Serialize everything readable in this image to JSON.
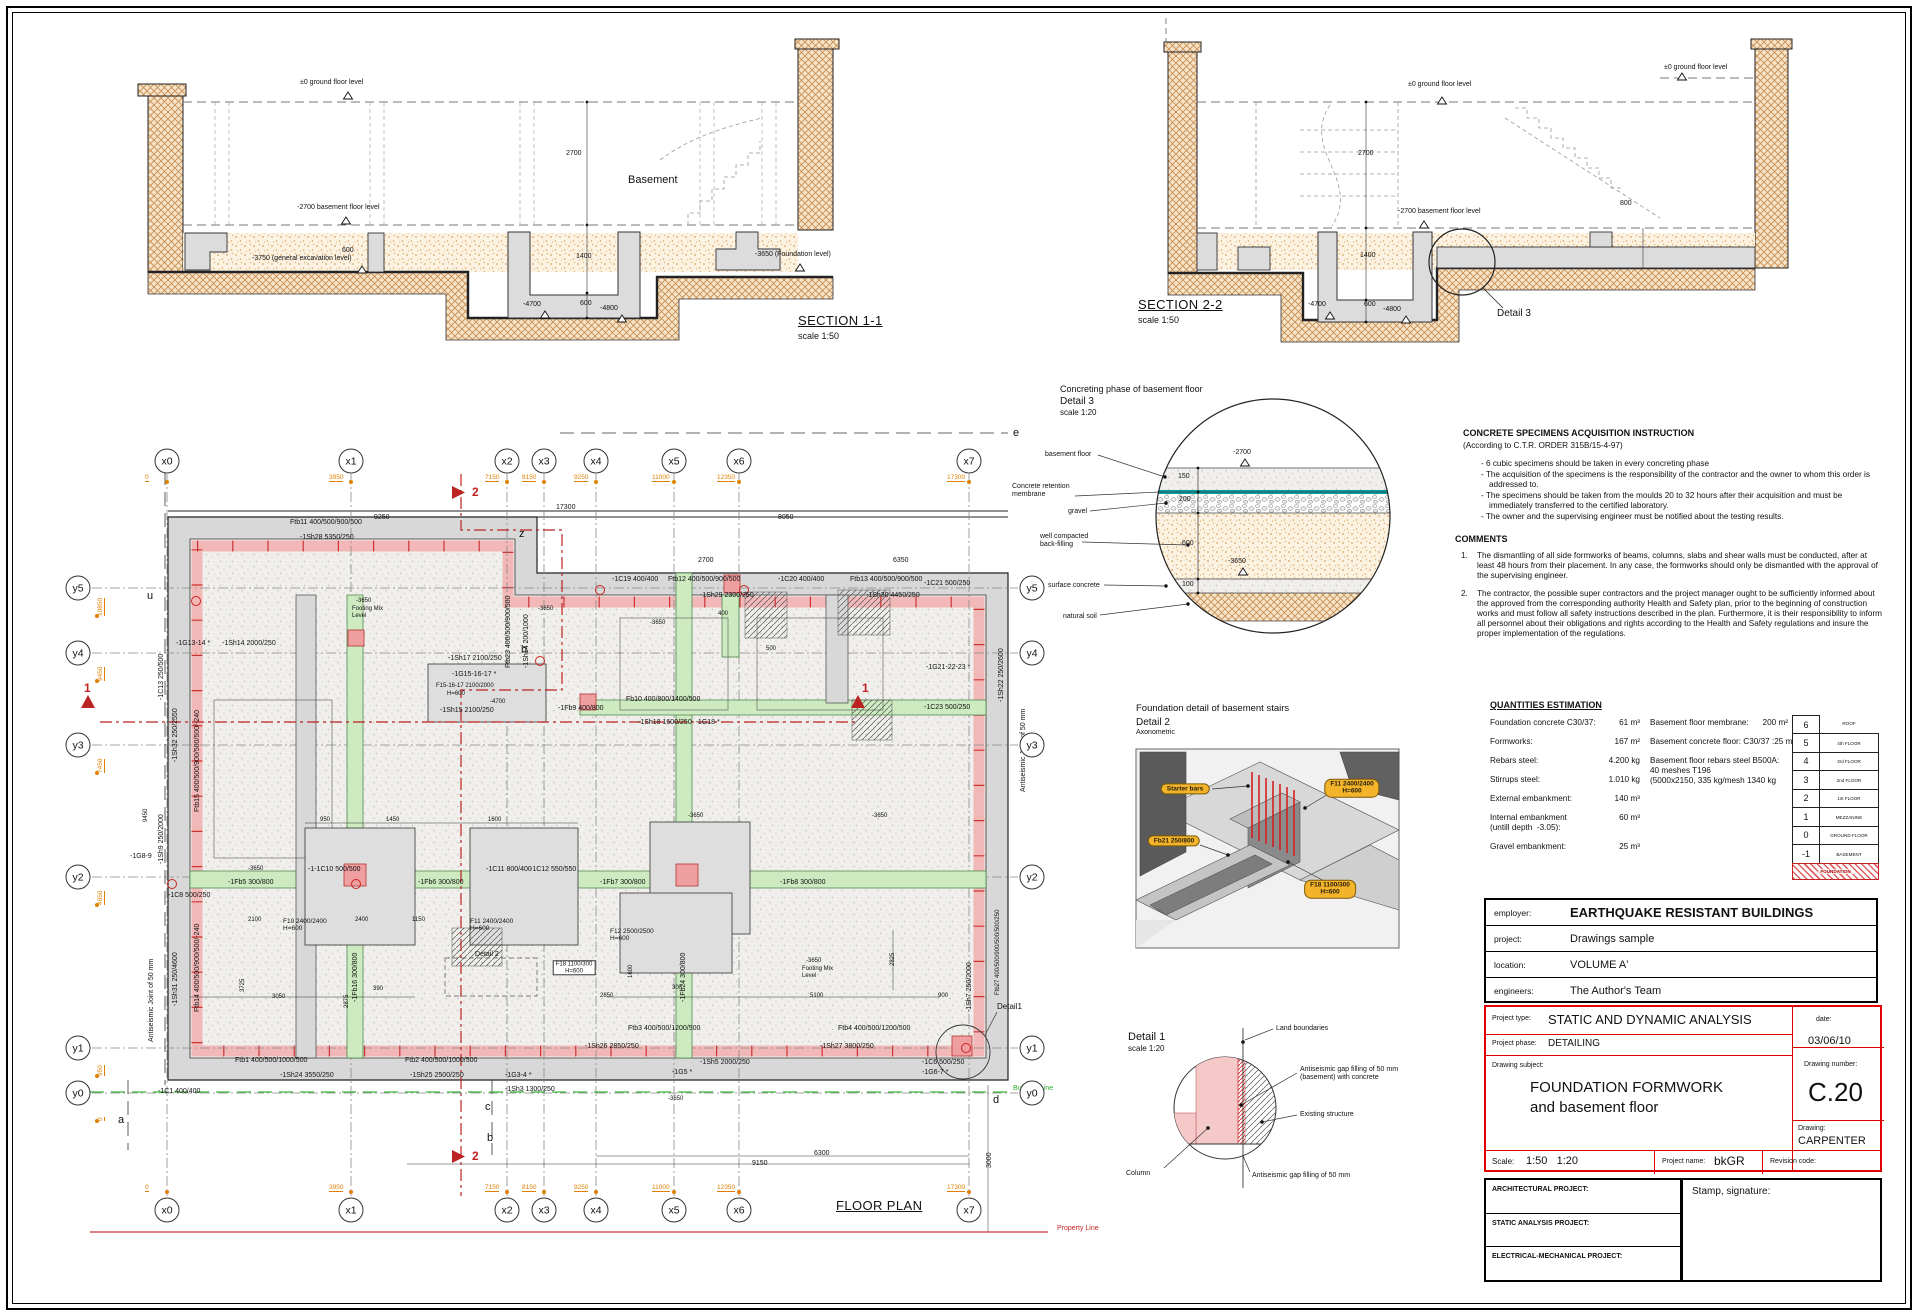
{
  "domain_note": "foundation formwork CAD sheet",
  "accent_colors": {
    "soil": "#c98f52",
    "backfill": "#dca45f",
    "pink_slab": "#f2b8b8",
    "green_beam": "#cdeac0",
    "membrane_teal": "#009e9e",
    "pill_yellow": "#f3b32b",
    "red": "#c22222",
    "orange_dim": "#e08000"
  },
  "instructions": {
    "title": "CONCRETE SPECIMENS ACQUISITION INSTRUCTION",
    "subtitle": "(According to C.T.R. ORDER 315B/15-4-97)",
    "bullets": [
      "- 6 cubic specimens should be taken in every concreting phase",
      "- The acquisition of the specimens is the responsibility of the contractor and the owner to whom this order is addressed to.",
      "- The specimens should be taken from the moulds 20 to 32 hours after their acquisition and must be immediately transferred to the certified laboratory.",
      "- The owner and the supervising engineer must be notified about the testing results."
    ]
  },
  "comments": {
    "title": "COMMENTS",
    "items": [
      {
        "n": "1.",
        "t": "The dismantling of all side formworks of beams, columns, slabs and shear walls must be conducted, after at least 48 hours from their placement. In any case, the formworks should only be dismantled with the approval of the supervising engineer."
      },
      {
        "n": "2.",
        "t": "The contractor, the possible super contractors and the project manager ought to be sufficiently informed about the approved from the corresponding authority Health and Safety plan, prior to the beginning of construction works and must follow all safety instructions described in the plan. Furthermore, it is their responsibility to inform all personnel about their obligations and rights according to the Health and Safety regulations and insure the proper implementation of the regulations."
      }
    ]
  },
  "quantities": {
    "title": "QUANTITIES ESTIMATION",
    "left": [
      {
        "l": "Foundation concrete C30/37:",
        "v": "61 m³"
      },
      {
        "l": "Formworks:",
        "v": "167 m²"
      },
      {
        "l": "Rebars steel:",
        "v": "4.200 kg"
      },
      {
        "l": "Stirrups steel:",
        "v": "1.010 kg"
      },
      {
        "l": "External embankment:",
        "v": "140 m³"
      },
      {
        "l": "Internal embankment\n(untill depth  -3.05):",
        "v": "60 m³"
      },
      {
        "l": "Gravel embankment:",
        "v": "25 m³"
      }
    ],
    "right": [
      {
        "l": "Basement floor membrane:",
        "v": "200 m²"
      },
      {
        "l": "Basement concrete floor: C30/37 :",
        "v": "25 m³"
      },
      {
        "l": "Basement floor rebars steel B500A:\n40 meshes T196\n(5000x2150, 335 kg/mesh 1340 kg",
        "v": ""
      }
    ]
  },
  "storeys": [
    {
      "n": "6",
      "l": "ROOF",
      "nb": true
    },
    {
      "n": "5",
      "l": "4th FLOOR"
    },
    {
      "n": "4",
      "l": "3rd FLOOR"
    },
    {
      "n": "3",
      "l": "2nd FLOOR"
    },
    {
      "n": "2",
      "l": "1st FLOOR"
    },
    {
      "n": "1",
      "l": "MEZZANINE"
    },
    {
      "n": "0",
      "l": "GROUND FLOOR"
    },
    {
      "n": "-1",
      "l": "BASEMENT"
    },
    {
      "n": "",
      "l": "FOUNDATION",
      "red": true
    }
  ],
  "title_block": {
    "employer_label": "employer:",
    "employer": "EARTHQUAKE RESISTANT BUILDINGS",
    "project_label": "project:",
    "project": "Drawings sample",
    "location_label": "location:",
    "location": "VOLUME A'",
    "engineers_label": "engineers:",
    "engineers": "The Author's Team",
    "project_type_label": "Project type:",
    "project_type": "STATIC AND DYNAMIC ANALYSIS",
    "date_label": "date:",
    "date": "03/06/10",
    "project_phase_label": "Project phase:",
    "project_phase": "DETAILING",
    "drawing_subject_label": "Drawing subject:",
    "drawing_subject_1": "FOUNDATION FORMWORK",
    "drawing_subject_2": "and basement floor",
    "drawing_number_label": "Drawing number:",
    "drawing_number": "C.20",
    "drawing_label": "Drawing:",
    "drawing": "CARPENTER",
    "scale_label": "Scale:",
    "scale": "1:50   1:20",
    "project_name_label": "Project name:",
    "project_name": "bkGR",
    "revision_label": "Revision code:",
    "arch_label": "ARCHITECTURAL PROJECT:",
    "static_label": "STATIC ANALYSIS PROJECT:",
    "em_label": "ELECTRICAL-MECHANICAL PROJECT:",
    "stamp_label": "Stamp, signature:"
  },
  "floor_plan": {
    "grid_x": [
      {
        "id": "x0",
        "x": 167,
        "dim": "0"
      },
      {
        "id": "x1",
        "x": 351,
        "dim": "3950"
      },
      {
        "id": "x2",
        "x": 507,
        "dim": "7150"
      },
      {
        "id": "x3",
        "x": 544,
        "dim": "8150"
      },
      {
        "id": "x4",
        "x": 596,
        "dim": "9250"
      },
      {
        "id": "x5",
        "x": 674,
        "dim": "11000"
      },
      {
        "id": "x6",
        "x": 739,
        "dim": "12350"
      },
      {
        "id": "x7",
        "x": 969,
        "dim": "17300"
      }
    ],
    "grid_y": [
      {
        "id": "y5",
        "y": 588,
        "dim": "10850"
      },
      {
        "id": "y4",
        "y": 653,
        "dim": "9450"
      },
      {
        "id": "y3",
        "y": 745,
        "dim": "7450"
      },
      {
        "id": "y2",
        "y": 877,
        "dim": "4650"
      },
      {
        "id": "y1",
        "y": 1048,
        "dim": "950"
      },
      {
        "id": "y0",
        "y": 1093,
        "dim": "0"
      }
    ]
  },
  "labels": [
    {
      "x": 300,
      "y": 79,
      "t": "±0 ground floor level"
    },
    {
      "x": 297,
      "y": 204,
      "t": "-2700 basement floor level"
    },
    {
      "x": 252,
      "y": 255,
      "t": "-3750 (general excavation level)"
    },
    {
      "x": 755,
      "y": 251,
      "t": "-3650 (Foundation level)"
    },
    {
      "x": 628,
      "y": 174,
      "t": "Basement",
      "fs": 11
    },
    {
      "x": 566,
      "y": 150,
      "t": "2700"
    },
    {
      "x": 576,
      "y": 253,
      "t": "1400"
    },
    {
      "x": 580,
      "y": 300,
      "t": "600"
    },
    {
      "x": 523,
      "y": 301,
      "t": "-4700"
    },
    {
      "x": 600,
      "y": 305,
      "t": "-4800"
    },
    {
      "x": 342,
      "y": 247,
      "t": "600"
    },
    {
      "x": 798,
      "y": 314,
      "t": "SECTION 1-1",
      "fs": 13,
      "cls": "tt"
    },
    {
      "x": 798,
      "y": 331,
      "t": "scale 1:50",
      "fs": 9
    },
    {
      "x": 1408,
      "y": 81,
      "t": "±0 ground floor level"
    },
    {
      "x": 1398,
      "y": 208,
      "t": "-2700 basement floor level"
    },
    {
      "x": 1664,
      "y": 64,
      "t": "±0 ground floor level"
    },
    {
      "x": 1358,
      "y": 150,
      "t": "2700"
    },
    {
      "x": 1360,
      "y": 252,
      "t": "1400"
    },
    {
      "x": 1364,
      "y": 301,
      "t": "600"
    },
    {
      "x": 1308,
      "y": 301,
      "t": "-4700"
    },
    {
      "x": 1383,
      "y": 306,
      "t": "-4800"
    },
    {
      "x": 1620,
      "y": 200,
      "t": "800"
    },
    {
      "x": 1138,
      "y": 298,
      "t": "SECTION 2-2",
      "fs": 13,
      "cls": "tt"
    },
    {
      "x": 1138,
      "y": 315,
      "t": "scale 1:50",
      "fs": 9
    },
    {
      "x": 1497,
      "y": 308,
      "t": "Detail 3",
      "fs": 10
    },
    {
      "x": 1060,
      "y": 384,
      "t": "Concreting phase of basement floor",
      "fs": 9
    },
    {
      "x": 1060,
      "y": 396,
      "t": "Detail 3",
      "fs": 10
    },
    {
      "x": 1060,
      "y": 409,
      "t": "scale 1:20",
      "fs": 8
    },
    {
      "x": 1045,
      "y": 451,
      "t": "basement floor"
    },
    {
      "x": 1012,
      "y": 483,
      "t": "Concrete retention\nmembrane"
    },
    {
      "x": 1068,
      "y": 508,
      "t": "gravel"
    },
    {
      "x": 1040,
      "y": 533,
      "t": "well compacted\nback-filling"
    },
    {
      "x": 1048,
      "y": 582,
      "t": "surface concrete"
    },
    {
      "x": 1063,
      "y": 613,
      "t": "natural soil"
    },
    {
      "x": 1233,
      "y": 449,
      "t": "-2700"
    },
    {
      "x": 1178,
      "y": 473,
      "t": "150"
    },
    {
      "x": 1179,
      "y": 496,
      "t": "200"
    },
    {
      "x": 1182,
      "y": 540,
      "t": "600"
    },
    {
      "x": 1228,
      "y": 558,
      "t": "-3650"
    },
    {
      "x": 1182,
      "y": 581,
      "t": "100"
    },
    {
      "x": 1136,
      "y": 704,
      "t": "Foundation detail of basement stairs",
      "fs": 9.5
    },
    {
      "x": 1136,
      "y": 717,
      "t": "Detail 2",
      "fs": 10
    },
    {
      "x": 1136,
      "y": 729,
      "t": "Axonometric",
      "fs": 7
    },
    {
      "x": 1185,
      "y": 789,
      "t": "Starter bars",
      "cls": "pill"
    },
    {
      "x": 1352,
      "y": 788,
      "t": "F11 2400/2400\nH=600",
      "cls": "pill"
    },
    {
      "x": 1174,
      "y": 841,
      "t": "Fb21 250/800",
      "cls": "pill"
    },
    {
      "x": 1330,
      "y": 889,
      "t": "F18 1100/300\nH=600",
      "cls": "pill"
    },
    {
      "x": 1128,
      "y": 1031,
      "t": "Detail 1",
      "fs": 11
    },
    {
      "x": 1128,
      "y": 1045,
      "t": "scale 1:20",
      "fs": 8
    },
    {
      "x": 1276,
      "y": 1025,
      "t": "Land boundaries"
    },
    {
      "x": 1300,
      "y": 1066,
      "t": "Antiseismic gap filling of 50 mm\n(basement) with concrete"
    },
    {
      "x": 1300,
      "y": 1111,
      "t": "Existing structure"
    },
    {
      "x": 1126,
      "y": 1170,
      "t": "Column"
    },
    {
      "x": 1252,
      "y": 1172,
      "t": "Antiseismic gap filling of 50 mm"
    },
    {
      "x": 290,
      "y": 519,
      "t": "Ftb11 400/500/900/500"
    },
    {
      "x": 300,
      "y": 534,
      "t": "-1Sh28 5350/250"
    },
    {
      "x": 176,
      "y": 640,
      "t": "-1G13-14 *"
    },
    {
      "x": 222,
      "y": 640,
      "t": "-1Sh14 2000/250"
    },
    {
      "x": 612,
      "y": 576,
      "t": "-1C19 400/400"
    },
    {
      "x": 668,
      "y": 576,
      "t": "Ftb12 400/500/900/500"
    },
    {
      "x": 700,
      "y": 592,
      "t": "-1Sh29 2300/250"
    },
    {
      "x": 778,
      "y": 576,
      "t": "-1C20 400/400"
    },
    {
      "x": 850,
      "y": 576,
      "t": "Ftb13 400/500/900/500"
    },
    {
      "x": 866,
      "y": 592,
      "t": "-1Sh30 4450/250"
    },
    {
      "x": 924,
      "y": 580,
      "t": "-1C21 500/250"
    },
    {
      "x": 926,
      "y": 664,
      "t": "-1G21-22-23 *"
    },
    {
      "x": 924,
      "y": 704,
      "t": "-1C23 500/250"
    },
    {
      "x": 505,
      "y": 668,
      "t": "Ftb23 400/500/900/500",
      "rot": 1
    },
    {
      "x": 523,
      "y": 668,
      "t": "-1Sh14 200/1000",
      "rot": 1
    },
    {
      "x": 448,
      "y": 655,
      "t": "-1Sh17 2100/250"
    },
    {
      "x": 452,
      "y": 671,
      "t": "-1G15-16-17 *"
    },
    {
      "x": 436,
      "y": 683,
      "t": "F15-16-17 2100/2000",
      "fs": 6
    },
    {
      "x": 447,
      "y": 691,
      "t": "H=600",
      "fs": 6
    },
    {
      "x": 490,
      "y": 699,
      "t": "-4700",
      "fs": 6
    },
    {
      "x": 440,
      "y": 707,
      "t": "-1Sh15 2100/250"
    },
    {
      "x": 558,
      "y": 705,
      "t": "-1Fb9 400/800"
    },
    {
      "x": 626,
      "y": 696,
      "t": "Fb10 400/800/1400/500"
    },
    {
      "x": 638,
      "y": 719,
      "t": "-1Sh18 1600/250  -1G18 *"
    },
    {
      "x": 158,
      "y": 700,
      "t": "-1C13 250/500",
      "rot": 1
    },
    {
      "x": 172,
      "y": 762,
      "t": "-1Sh32 250/2550",
      "rot": 1
    },
    {
      "x": 194,
      "y": 812,
      "t": "Ftb15 400/500/900/500/500/-240",
      "rot": 1
    },
    {
      "x": 158,
      "y": 864,
      "t": "-1Sh9 250/2000",
      "rot": 1
    },
    {
      "x": 130,
      "y": 853,
      "t": "-1G8-9"
    },
    {
      "x": 168,
      "y": 892,
      "t": "-1C8 500/250"
    },
    {
      "x": 228,
      "y": 879,
      "t": "-1Fb5 300/800"
    },
    {
      "x": 308,
      "y": 866,
      "t": "-1-1C10 500/500"
    },
    {
      "x": 418,
      "y": 879,
      "t": "-1Fb6 300/800"
    },
    {
      "x": 486,
      "y": 866,
      "t": "-1C11 800/400"
    },
    {
      "x": 530,
      "y": 866,
      "t": "-1C12 550/550"
    },
    {
      "x": 600,
      "y": 879,
      "t": "-1Fb7 300/800"
    },
    {
      "x": 780,
      "y": 879,
      "t": "-1Fb8 300/800"
    },
    {
      "x": 283,
      "y": 918,
      "t": "F10 2400/2400\nH=600",
      "fs": 6.5
    },
    {
      "x": 470,
      "y": 918,
      "t": "F11 2400/2400\nH=600",
      "fs": 6.5
    },
    {
      "x": 610,
      "y": 928,
      "t": "F12 2500/2500\nH=600",
      "fs": 6.5
    },
    {
      "x": 352,
      "y": 1002,
      "t": "-1Fb16 300/800",
      "rot": 1
    },
    {
      "x": 680,
      "y": 1002,
      "t": "-1Fb24 300/800",
      "rot": 1
    },
    {
      "x": 574,
      "y": 968,
      "t": "F18 1100/300\nH=600",
      "cls": "fbox"
    },
    {
      "x": 475,
      "y": 951,
      "t": "Detail 2"
    },
    {
      "x": 172,
      "y": 1006,
      "t": "-1Sh31 250/4600",
      "rot": 1
    },
    {
      "x": 194,
      "y": 1012,
      "t": "Ftb14 400/500/900/500/-240",
      "rot": 1
    },
    {
      "x": 148,
      "y": 1042,
      "t": "Antiseismic Joint of 50 mm",
      "rot": 1
    },
    {
      "x": 1020,
      "y": 792,
      "t": "Antiseismic Joint of 50 mm",
      "rot": 1
    },
    {
      "x": 998,
      "y": 702,
      "t": "-1Sh22 250/2600",
      "rot": 1
    },
    {
      "x": 966,
      "y": 1012,
      "t": "-1Sh7 250/2000",
      "rot": 1
    },
    {
      "x": 995,
      "y": 995,
      "t": "Ftb27 400/500/900/500/500/250",
      "rot": 1,
      "fs": 6
    },
    {
      "x": 628,
      "y": 1025,
      "t": "Ftb3 400/500/1200/500"
    },
    {
      "x": 838,
      "y": 1025,
      "t": "Ftb4 400/500/1200/500"
    },
    {
      "x": 585,
      "y": 1043,
      "t": "-1Sh26 2850/250"
    },
    {
      "x": 820,
      "y": 1043,
      "t": "-1Sh27 3800/250"
    },
    {
      "x": 700,
      "y": 1059,
      "t": "-1Sh5 2000/250"
    },
    {
      "x": 672,
      "y": 1069,
      "t": "-1G5 *"
    },
    {
      "x": 922,
      "y": 1059,
      "t": "-1C6 500/250"
    },
    {
      "x": 922,
      "y": 1069,
      "t": "-1G6-7 *"
    },
    {
      "x": 997,
      "y": 1003,
      "t": "Detail1",
      "fs": 8
    },
    {
      "x": 158,
      "y": 1088,
      "t": "-1C1 400/400"
    },
    {
      "x": 235,
      "y": 1057,
      "t": "Ftb1 400/500/1000/500"
    },
    {
      "x": 280,
      "y": 1072,
      "t": "-1Sh24 3550/250"
    },
    {
      "x": 405,
      "y": 1057,
      "t": "Ftb2 400/500/1000/500"
    },
    {
      "x": 410,
      "y": 1072,
      "t": "-1Sh25 2500/250"
    },
    {
      "x": 505,
      "y": 1072,
      "t": "-1G3-4 *"
    },
    {
      "x": 505,
      "y": 1086,
      "t": "-1Sh3 1300/250"
    },
    {
      "x": 374,
      "y": 514,
      "t": "9250"
    },
    {
      "x": 778,
      "y": 514,
      "t": "8050"
    },
    {
      "x": 556,
      "y": 504,
      "t": "17300"
    },
    {
      "x": 698,
      "y": 557,
      "t": "2700"
    },
    {
      "x": 893,
      "y": 557,
      "t": "6350"
    },
    {
      "x": 320,
      "y": 817,
      "t": "950",
      "fs": 6
    },
    {
      "x": 386,
      "y": 817,
      "t": "1450",
      "fs": 6
    },
    {
      "x": 488,
      "y": 817,
      "t": "1600",
      "fs": 6
    },
    {
      "x": 248,
      "y": 917,
      "t": "2100",
      "fs": 6
    },
    {
      "x": 355,
      "y": 917,
      "t": "2400",
      "fs": 6
    },
    {
      "x": 412,
      "y": 917,
      "t": "1150",
      "fs": 6
    },
    {
      "x": 272,
      "y": 994,
      "t": "3050",
      "fs": 6
    },
    {
      "x": 600,
      "y": 993,
      "t": "2850",
      "fs": 6
    },
    {
      "x": 810,
      "y": 993,
      "t": "5100",
      "fs": 6
    },
    {
      "x": 938,
      "y": 993,
      "t": "900",
      "fs": 6
    },
    {
      "x": 672,
      "y": 985,
      "t": "300",
      "fs": 6
    },
    {
      "x": 373,
      "y": 986,
      "t": "390",
      "fs": 6
    },
    {
      "x": 718,
      "y": 611,
      "t": "400",
      "fs": 6
    },
    {
      "x": 766,
      "y": 646,
      "t": "500",
      "fs": 6
    },
    {
      "x": 240,
      "y": 992,
      "t": "3725",
      "rot": 1,
      "fs": 6
    },
    {
      "x": 344,
      "y": 1008,
      "t": "2875",
      "rot": 1,
      "fs": 6
    },
    {
      "x": 890,
      "y": 966,
      "t": "2825",
      "rot": 1,
      "fs": 6
    },
    {
      "x": 628,
      "y": 978,
      "t": "1600",
      "rot": 1,
      "fs": 6
    },
    {
      "x": 143,
      "y": 822,
      "t": "9450",
      "rot": 1,
      "fs": 6
    },
    {
      "x": 356,
      "y": 598,
      "t": "-3650",
      "fs": 6
    },
    {
      "x": 352,
      "y": 606,
      "t": "Footing Mix\nLevel",
      "fs": 6
    },
    {
      "x": 806,
      "y": 958,
      "t": "-3650",
      "fs": 6
    },
    {
      "x": 802,
      "y": 966,
      "t": "Footing Mix\nLevel",
      "fs": 6
    },
    {
      "x": 538,
      "y": 606,
      "t": "-3650",
      "fs": 6
    },
    {
      "x": 650,
      "y": 620,
      "t": "-3650",
      "fs": 6
    },
    {
      "x": 248,
      "y": 866,
      "t": "-3650",
      "fs": 6
    },
    {
      "x": 688,
      "y": 813,
      "t": "-3650",
      "fs": 6
    },
    {
      "x": 872,
      "y": 813,
      "t": "-3650",
      "fs": 6
    },
    {
      "x": 668,
      "y": 1096,
      "t": "-3650",
      "fs": 6
    },
    {
      "x": 147,
      "y": 590,
      "t": "u",
      "fs": 11
    },
    {
      "x": 519,
      "y": 528,
      "t": "z",
      "fs": 11
    },
    {
      "x": 521,
      "y": 644,
      "t": "h",
      "fs": 11
    },
    {
      "x": 1013,
      "y": 427,
      "t": "e",
      "fs": 11
    },
    {
      "x": 118,
      "y": 1114,
      "t": "a",
      "fs": 11
    },
    {
      "x": 487,
      "y": 1132,
      "t": "b",
      "fs": 11
    },
    {
      "x": 485,
      "y": 1101,
      "t": "c",
      "fs": 11
    },
    {
      "x": 993,
      "y": 1094,
      "t": "d",
      "fs": 11
    },
    {
      "x": 472,
      "y": 486,
      "t": "2",
      "cls": "r b",
      "fs": 12
    },
    {
      "x": 472,
      "y": 1150,
      "t": "2",
      "cls": "r b",
      "fs": 12
    },
    {
      "x": 84,
      "y": 682,
      "t": "1",
      "cls": "r b",
      "fs": 12
    },
    {
      "x": 862,
      "y": 682,
      "t": "1",
      "cls": "r b",
      "fs": 12
    },
    {
      "x": 1013,
      "y": 1085,
      "t": "Building Line",
      "cls": "g"
    },
    {
      "x": 1057,
      "y": 1225,
      "t": "Property Line",
      "cls": "r"
    },
    {
      "x": 836,
      "y": 1199,
      "t": "FLOOR PLAN",
      "fs": 13,
      "cls": "tt"
    },
    {
      "x": 814,
      "y": 1150,
      "t": "6300",
      "fs": 7
    },
    {
      "x": 752,
      "y": 1160,
      "t": "9150",
      "fs": 7
    },
    {
      "x": 986,
      "y": 1168,
      "t": "3000",
      "rot": 1,
      "fs": 7
    }
  ]
}
